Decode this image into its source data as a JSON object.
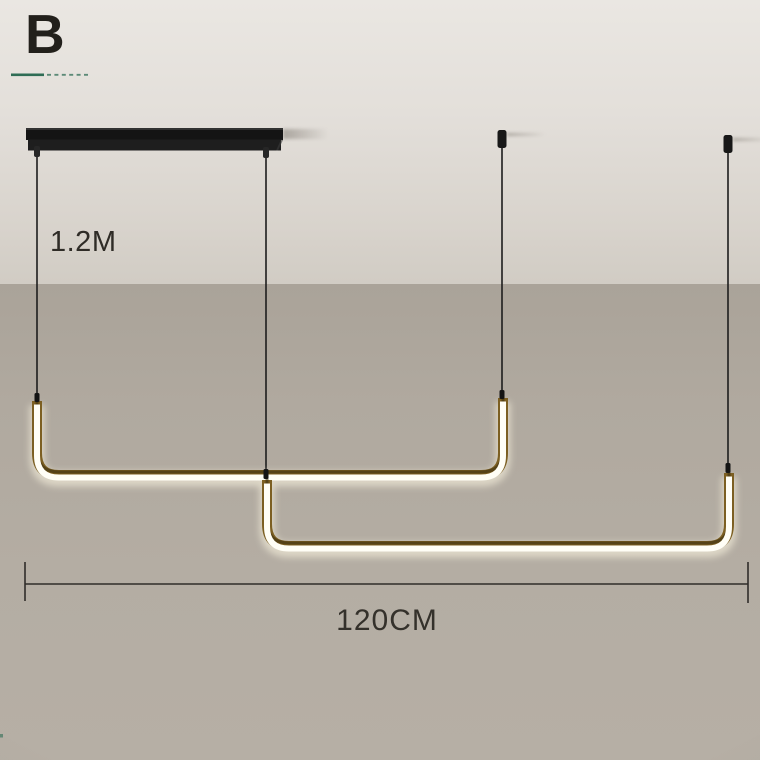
{
  "annotations": {
    "variant_label": "B",
    "cable_length_label": "1.2M",
    "fixture_width_label": "120CM"
  },
  "colors": {
    "ceiling_light": "#e7e4df",
    "wall_taupe": "#b2aba1",
    "canopy_black": "#141414",
    "cable_black": "#1d1d1d",
    "tube_brass": "#7c5f22",
    "tube_glow_core": "#fffef6",
    "tube_halo": "#fff9e4",
    "dimension_line": "#2f2d29",
    "accent_green": "#2f6d55",
    "label_text": "#2f2c27"
  }
}
